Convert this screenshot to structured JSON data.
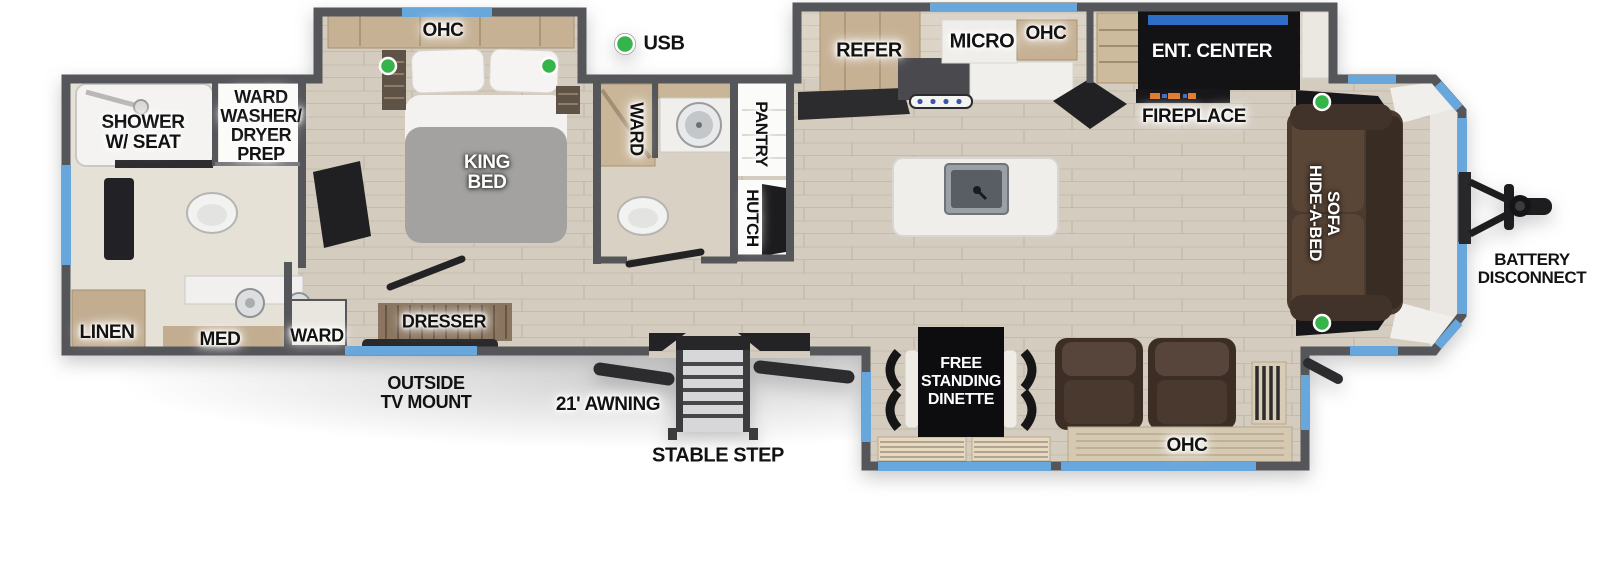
{
  "legend": {
    "usb": "USB"
  },
  "rear_bath": {
    "shower": "SHOWER\nW/ SEAT",
    "ward_washer_dryer": "WARD\nWASHER/\nDRYER\nPREP",
    "linen": "LINEN",
    "med": "MED"
  },
  "bedroom": {
    "ohc": "OHC",
    "king_bed": "KING\nBED",
    "ward": "WARD",
    "dresser": "DRESSER"
  },
  "mid_bath": {
    "ward": "WARD",
    "pantry": "PANTRY",
    "hutch": "HUTCH"
  },
  "kitchen": {
    "refer": "REFER",
    "micro": "MICRO",
    "ohc": "OHC",
    "ent_center": "ENT. CENTER",
    "fireplace": "FIREPLACE"
  },
  "living": {
    "hide_a_bed_sofa": "HIDE-A-BED\nSOFA",
    "free_standing_dinette": "FREE\nSTANDING\nDINETTE",
    "ohc": "OHC"
  },
  "exterior": {
    "battery_disconnect": "BATTERY\nDISCONNECT",
    "outside_tv_mount": "OUTSIDE\nTV MOUNT",
    "awning": "21' AWNING",
    "stable_step": "STABLE STEP"
  },
  "colors": {
    "wall": "#55565a",
    "window_blue": "#68a7dc",
    "usb_green": "#35b44a",
    "floor_wood": "#d4ccbf"
  }
}
